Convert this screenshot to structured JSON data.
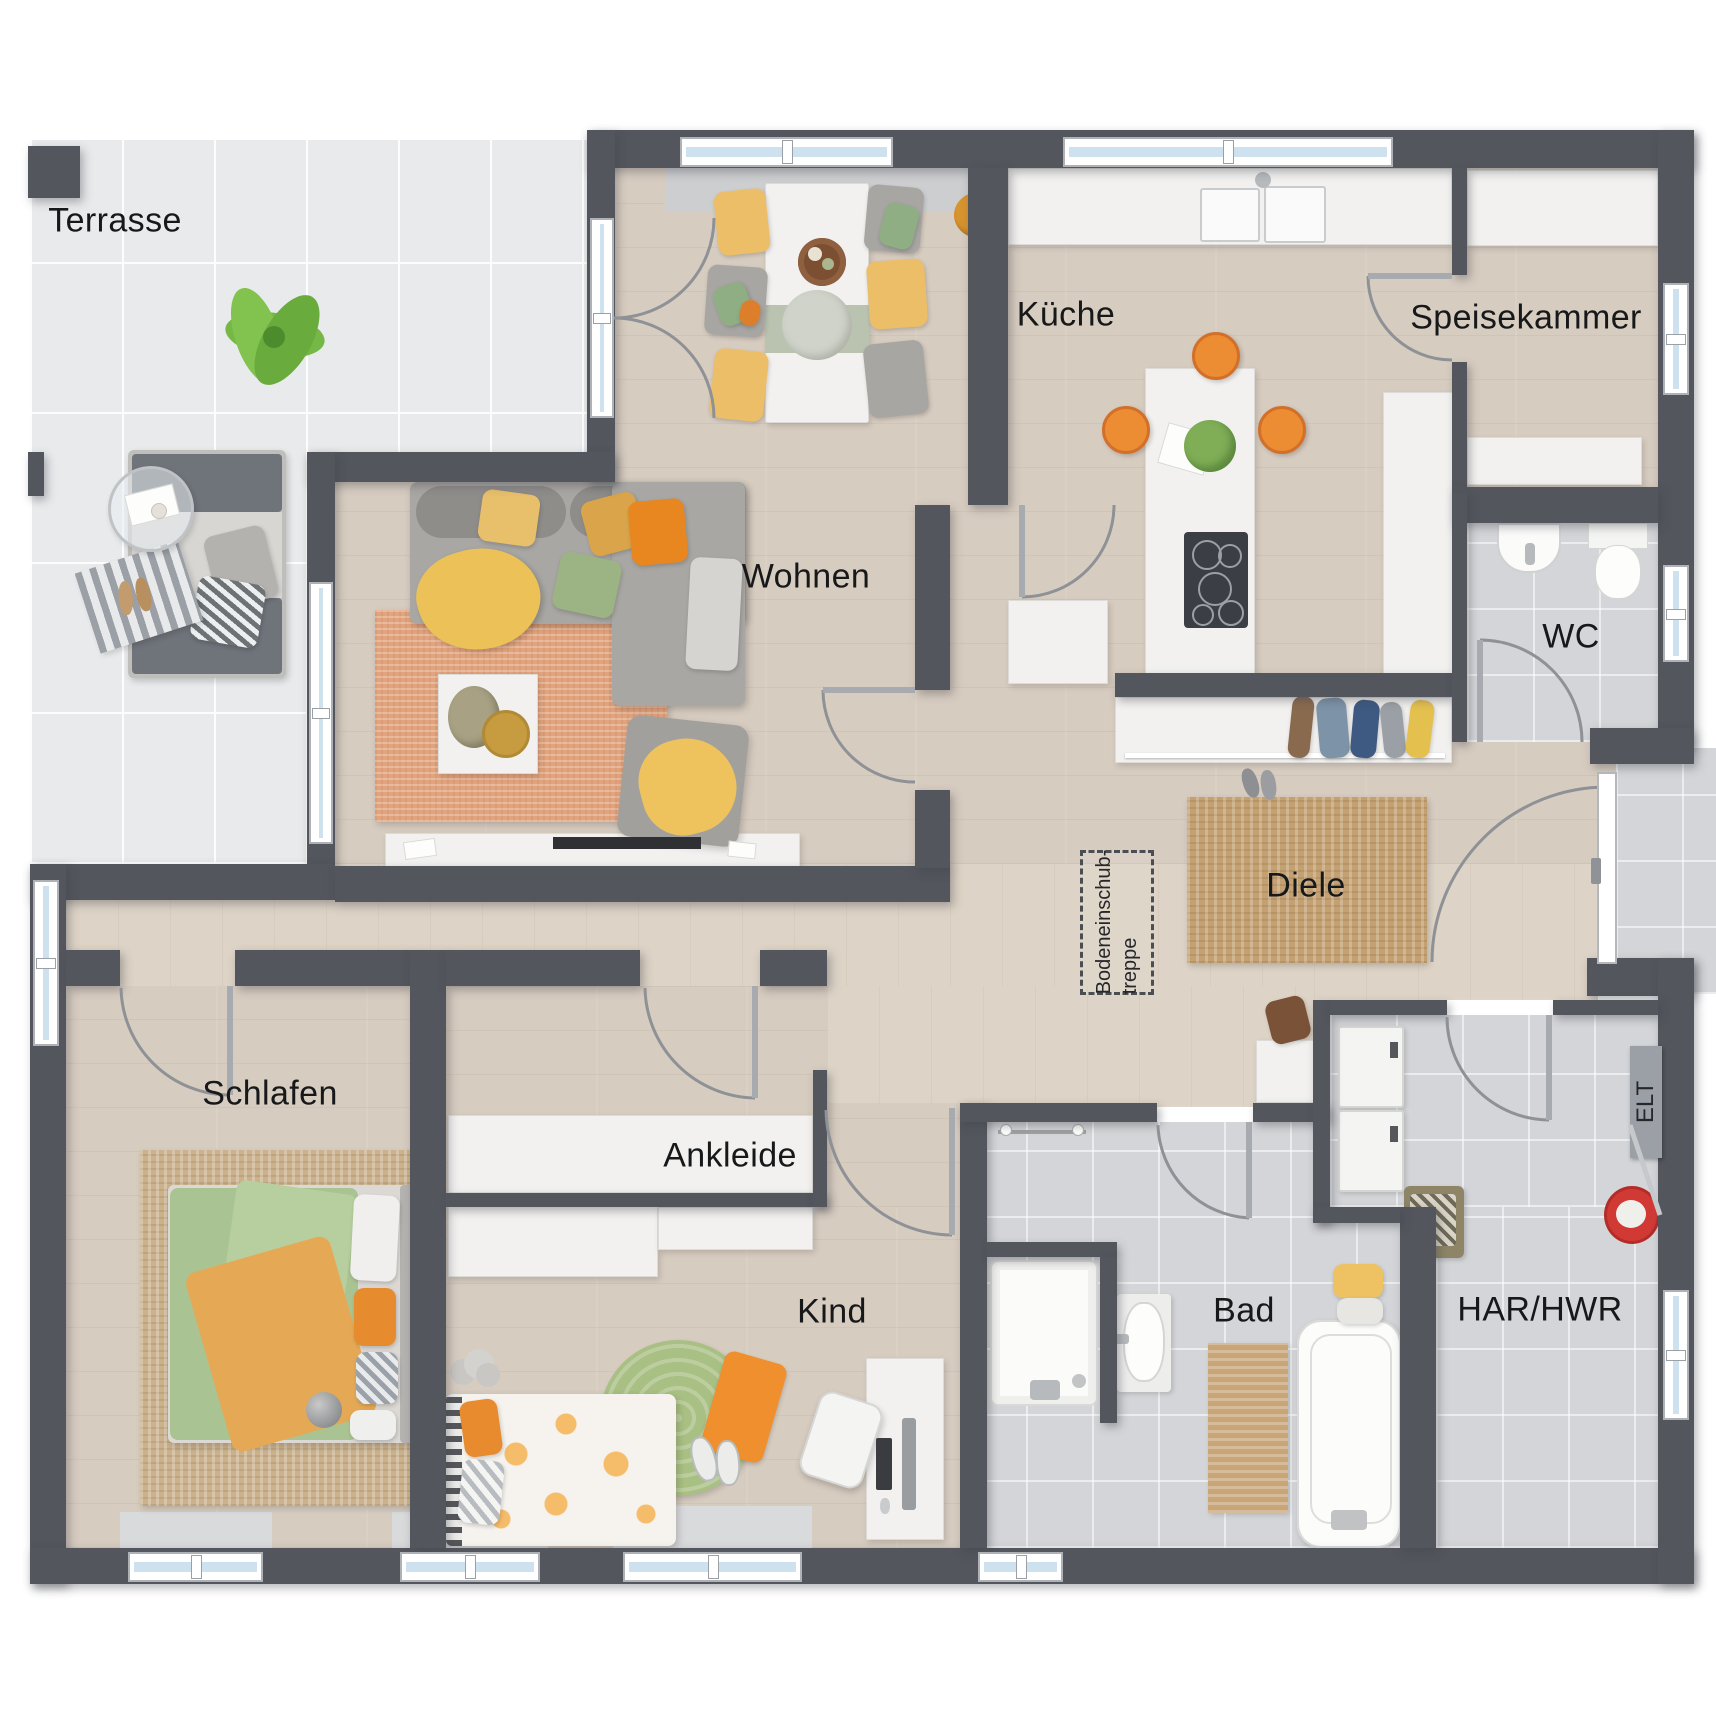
{
  "palette": {
    "wall": "#53565d",
    "wood_floor": "#d7ccc0",
    "terrace_tile": "#e9eaec",
    "bath_tile": "#d3d5d8",
    "window_glass": "#cde1ef",
    "accent_orange": "#ec8c33",
    "sofa_gray": "#a9a7a3",
    "living_rug_salmon": "#e2a47e",
    "jute_rug": "#c4a172",
    "bed_green": "#a9c492",
    "throw_yellow": "#ecc157",
    "mop_bucket_red": "#d13a34"
  },
  "rooms": {
    "terrasse": {
      "label": "Terrasse"
    },
    "kueche": {
      "label": "Küche"
    },
    "speisekammer": {
      "label": "Speisekammer"
    },
    "wc": {
      "label": "WC"
    },
    "wohnen": {
      "label": "Wohnen"
    },
    "diele": {
      "label": "Diele"
    },
    "schlafen": {
      "label": "Schlafen"
    },
    "ankleide": {
      "label": "Ankleide"
    },
    "kind": {
      "label": "Kind"
    },
    "bad": {
      "label": "Bad"
    },
    "har_hwr": {
      "label": "HAR/HWR"
    },
    "elt": {
      "label": "ELT"
    }
  },
  "annotations": {
    "attic_stairs_line1": "Bodeneinschub-",
    "attic_stairs_line2": "treppe"
  }
}
